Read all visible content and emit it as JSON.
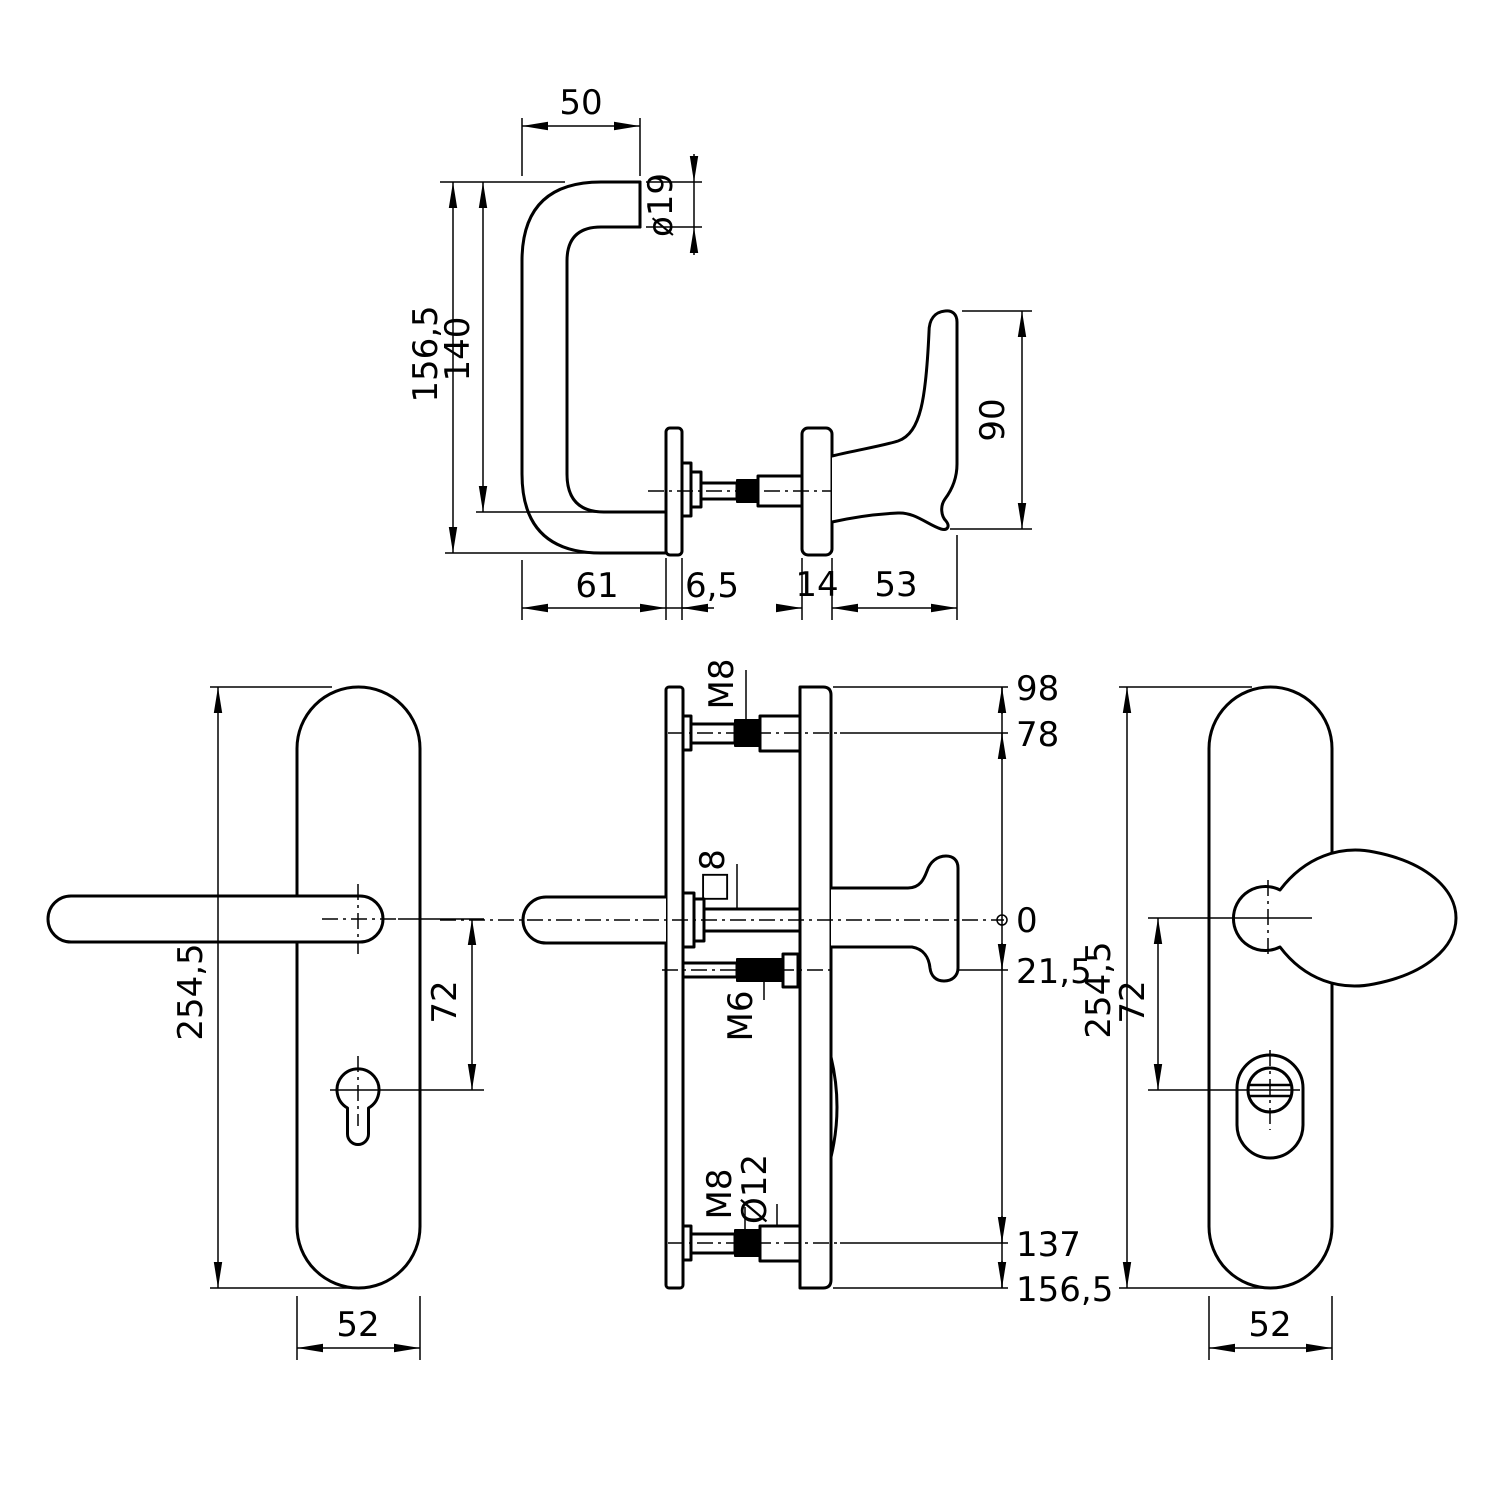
{
  "drawing": {
    "views": {
      "lever_side": {
        "label": "lever and knob side view",
        "dims": {
          "top_width": "50",
          "tube_dia": "ø19",
          "total_height": "156,5",
          "inner_height": "140",
          "lever_proj": "61",
          "rose_thickness": "6,5",
          "inner_rose_thickness": "14",
          "knob_proj": "53",
          "knob_height": "90"
        }
      },
      "outside_plate": {
        "label": "outside backplate front view",
        "dims": {
          "height": "254,5",
          "handle_to_cylinder": "72",
          "width": "52"
        }
      },
      "section": {
        "label": "assembly cross-section",
        "labels": {
          "top_bolt": "M8",
          "spindle": "□8",
          "grub_screw": "M6",
          "bottom_bolt": "M8",
          "sleeve_dia": "Ø12"
        },
        "ordinates": [
          "98",
          "78",
          "0",
          "21,5",
          "137",
          "156,5"
        ]
      },
      "inside_plate": {
        "label": "inside backplate front view",
        "dims": {
          "height": "254,5",
          "handle_to_cylinder": "72",
          "width": "52"
        }
      }
    }
  }
}
